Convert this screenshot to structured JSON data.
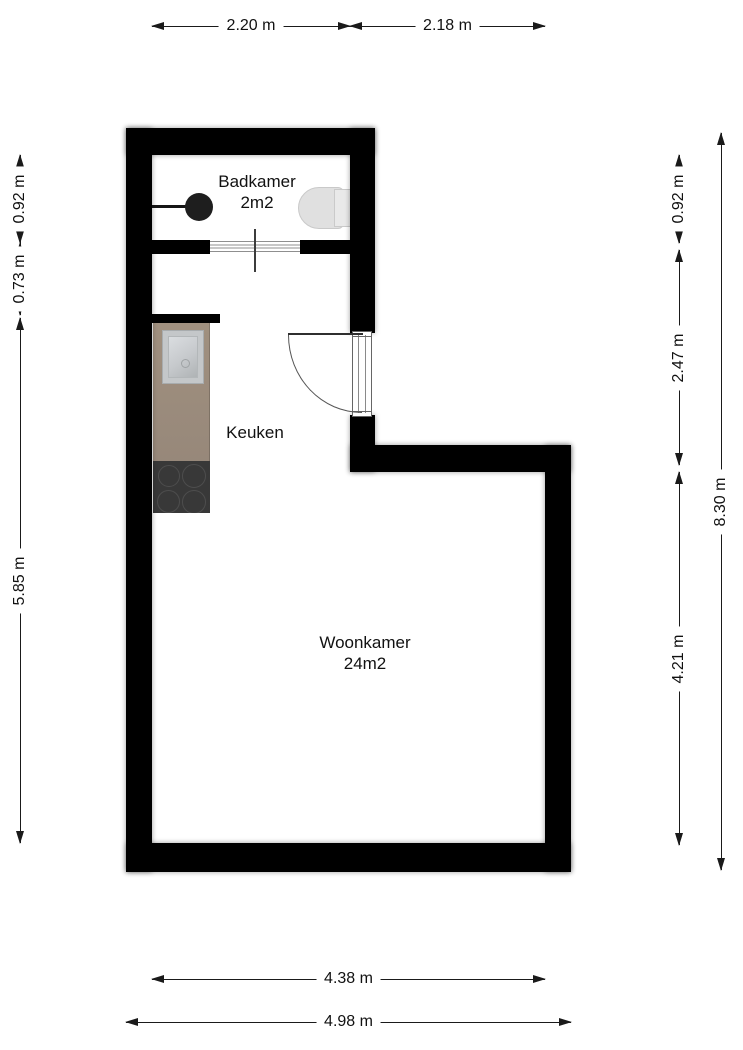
{
  "title": "Floor plan",
  "rooms": [
    {
      "name": "Badkamer",
      "area": "2m2"
    },
    {
      "name": "Keuken"
    },
    {
      "name": "Woonkamer",
      "area": "24m2"
    }
  ],
  "dims": {
    "top": [
      "2.20 m",
      "2.18 m"
    ],
    "left": [
      "0.92 m",
      "0.73 m",
      "5.85 m"
    ],
    "right": [
      "0.92 m",
      "2.47 m",
      "4.21 m"
    ],
    "right_total": "8.30 m",
    "bottom": [
      "4.38 m",
      "4.98 m"
    ]
  },
  "colors": {
    "wall": "#000000",
    "floor": "#ffffff",
    "dim_line": "#1a1a1a",
    "counter": "#9c8c7c",
    "stove": "#383838",
    "fixture_gray": "#e0e0e0",
    "sink_steel": "#c4c7c9",
    "bath_sink_black": "#1e1e1e"
  },
  "icons": {
    "bathroom_wall_sink": "filled-circle-with-stem",
    "toilet": "rounded-bowl-with-tank",
    "kitchen_sink": "beveled-steel-square",
    "stove": "four-burner-cooktop",
    "entrance_door": "quarter-arc-swing-door",
    "bathroom_door": "sliding-door-lines"
  }
}
